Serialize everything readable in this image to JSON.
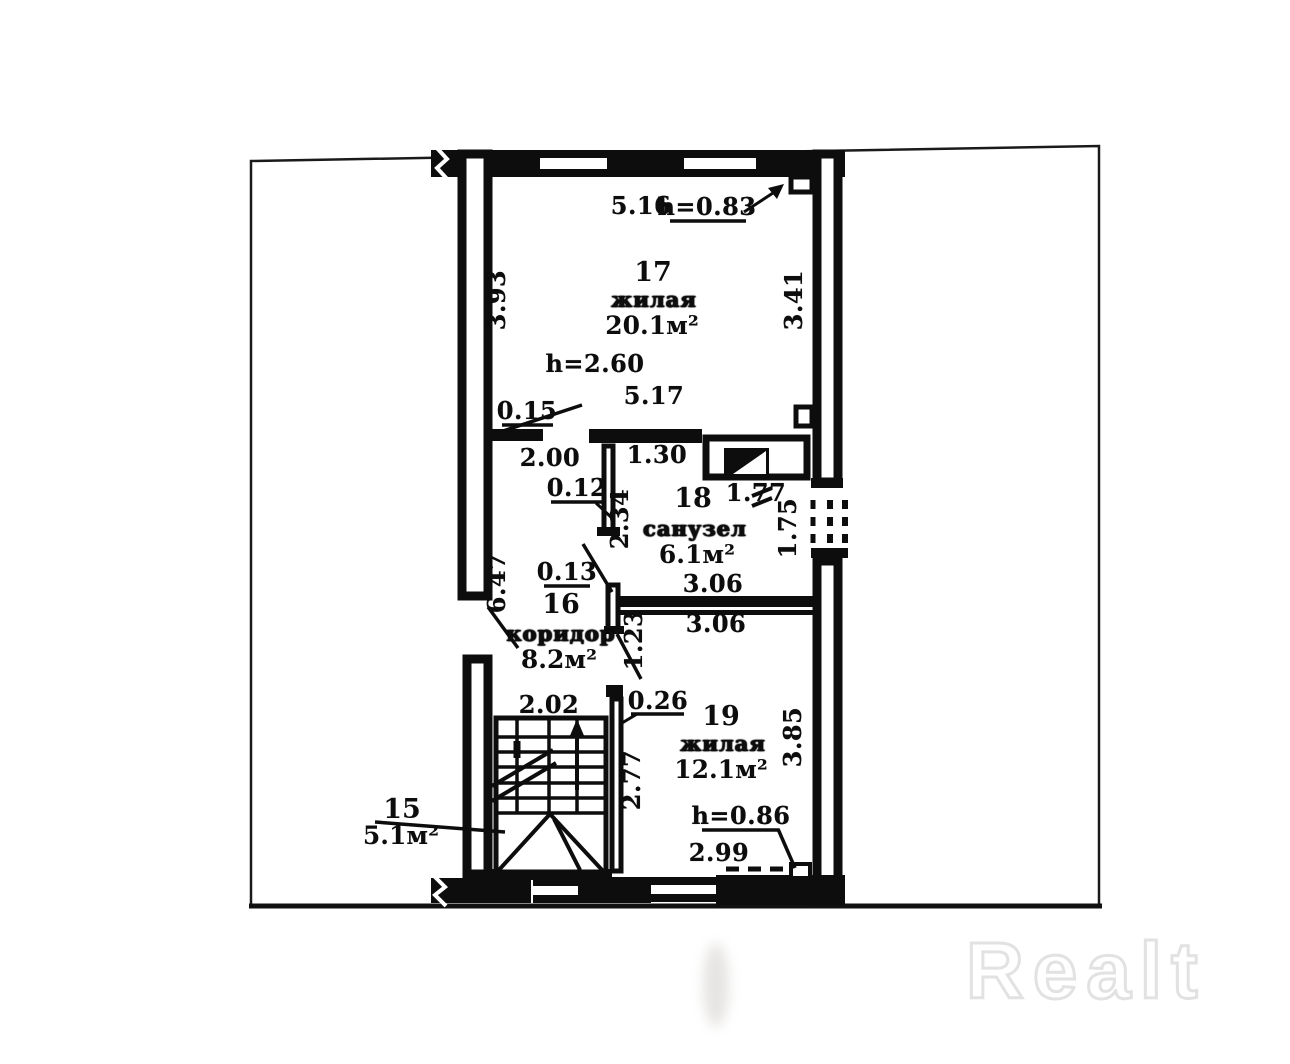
{
  "plan_type": "floor-plan",
  "rooms": {
    "r15": {
      "num": "15",
      "area": "5.1м²"
    },
    "r16": {
      "num": "16",
      "name": "коридор",
      "area": "8.2м²"
    },
    "r17": {
      "num": "17",
      "name": "жилая",
      "area": "20.1м²"
    },
    "r18": {
      "num": "18",
      "name": "санузел",
      "area": "6.1м²"
    },
    "r19": {
      "num": "19",
      "name": "жилая",
      "area": "12.1м²"
    }
  },
  "dims": {
    "w17_top": "5.16",
    "h_window17": "h=0.83",
    "w17_left": "3.93",
    "w17_right": "3.41",
    "h_ceiling": "h=2.60",
    "w17_bottom": "5.17",
    "t_stub": "0.15",
    "w_door17": "2.00",
    "t_part": "0.12",
    "l_part": "2.34",
    "w_wc_top": "1.30",
    "w_vent": "1.77",
    "w_opening_right": "1.75",
    "l_corridor": "6.47",
    "t_door_wc": "0.13",
    "w_wc_bottom": "3.06",
    "w_r19_top": "3.06",
    "l_part19": "1.23",
    "w_stairs": "2.02",
    "t_wall_stairs": "0.26",
    "l_wall_stairs": "2.77",
    "w_r19_right": "3.85",
    "h_low": "h=0.86",
    "w_low": "2.99"
  },
  "watermark": {
    "text": "Realt"
  },
  "colors": {
    "ink": "#0d0d0d",
    "watermark_outline": "#e2e2e2",
    "background": "#ffffff"
  }
}
